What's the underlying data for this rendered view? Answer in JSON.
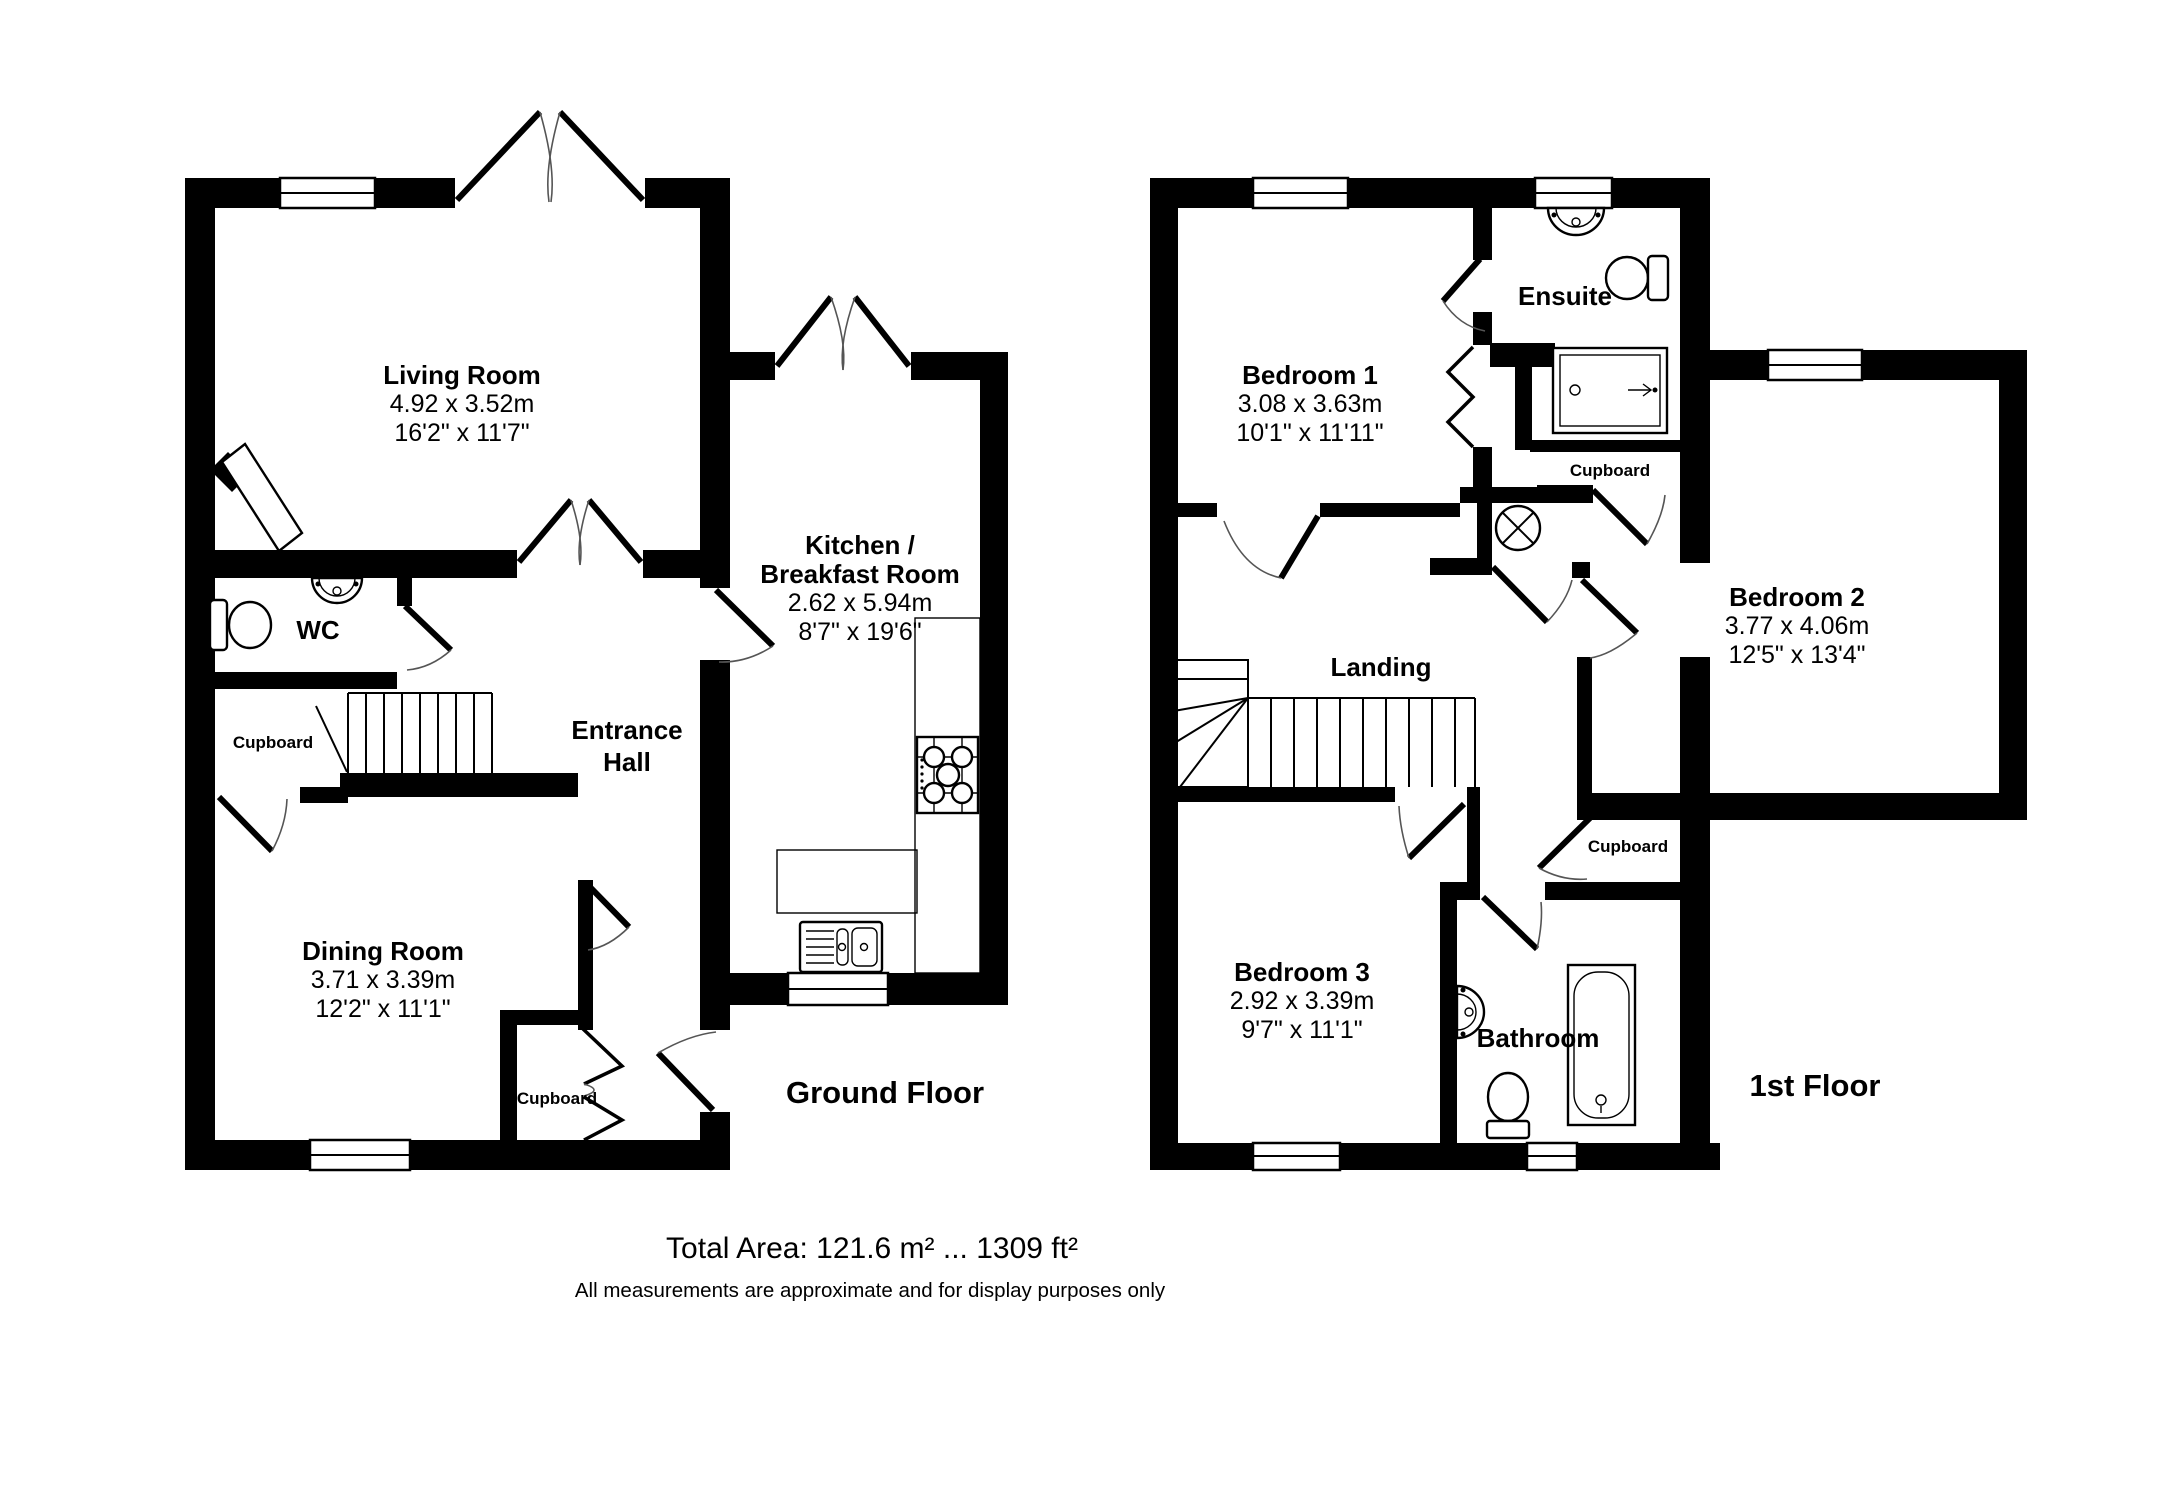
{
  "ground_floor": {
    "floor_label": "Ground Floor",
    "living_room": {
      "name": "Living Room",
      "metric": "4.92 x 3.52m",
      "imperial": "16'2\" x 11'7\""
    },
    "kitchen": {
      "name_line1": "Kitchen /",
      "name_line2": "Breakfast Room",
      "metric": "2.62 x 5.94m",
      "imperial": "8'7\" x 19'6\""
    },
    "wc": {
      "name": "WC"
    },
    "cupboard_understairs": {
      "name": "Cupboard"
    },
    "entrance_hall": {
      "name_line1": "Entrance",
      "name_line2": "Hall"
    },
    "dining_room": {
      "name": "Dining Room",
      "metric": "3.71 x 3.39m",
      "imperial": "12'2\" x 11'1\""
    },
    "cupboard_hall": {
      "name": "Cupboard"
    }
  },
  "first_floor": {
    "floor_label": "1st Floor",
    "bedroom1": {
      "name": "Bedroom 1",
      "metric": "3.08 x 3.63m",
      "imperial": "10'1\" x 11'11\""
    },
    "ensuite": {
      "name": "Ensuite"
    },
    "cupboard_top": {
      "name": "Cupboard"
    },
    "bedroom2": {
      "name": "Bedroom 2",
      "metric": "3.77 x 4.06m",
      "imperial": "12'5\" x 13'4\""
    },
    "landing": {
      "name": "Landing"
    },
    "cupboard_landing": {
      "name": "Cupboard"
    },
    "bedroom3": {
      "name": "Bedroom 3",
      "metric": "2.92 x 3.39m",
      "imperial": "9'7\" x 11'1\""
    },
    "bathroom": {
      "name": "Bathroom"
    }
  },
  "footer": {
    "total_area": "Total Area: 121.6 m² ... 1309 ft²",
    "disclaimer": "All measurements are approximate and for display purposes only"
  }
}
